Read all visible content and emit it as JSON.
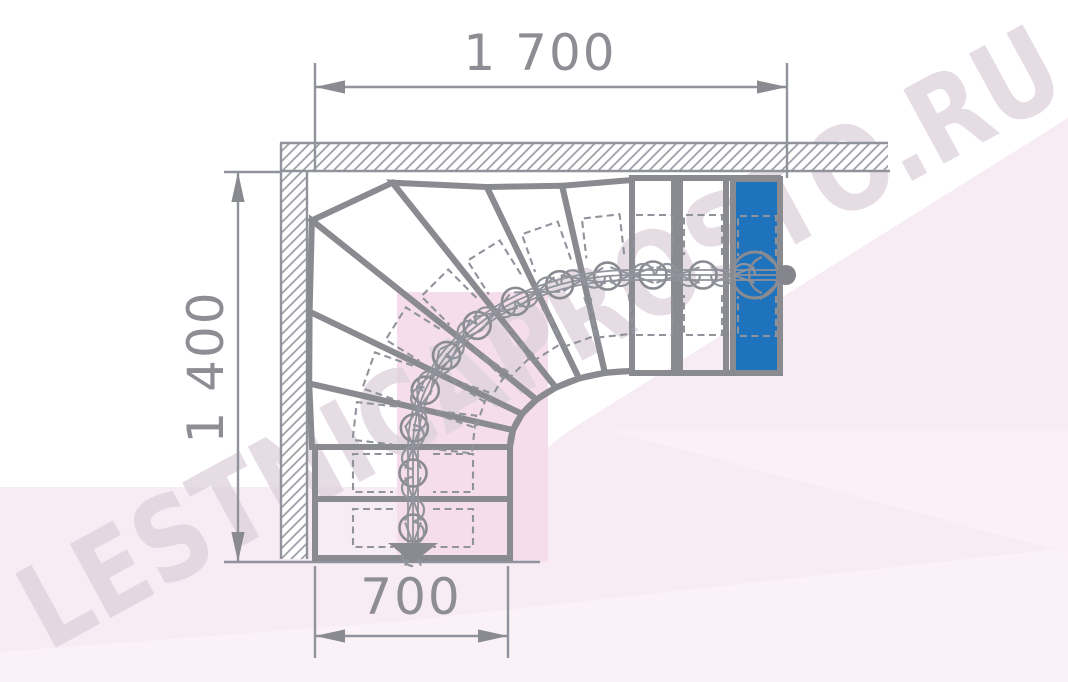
{
  "watermark": {
    "text": "LESTNICAPROSTO.RU"
  },
  "dimensions": {
    "top": "1 700",
    "left": "1 400",
    "bottom": "700"
  },
  "plan": {
    "straight_bottom_treads": 2,
    "winder_treads": 7,
    "right_treads": 3,
    "turn_angle_deg": 90,
    "highlighted_tread": "top-right landing tread (blue)"
  },
  "colors": {
    "line": "#8a8a91",
    "thin_line": "#90939b",
    "hatch": "#9a9aa3",
    "dim_text": "#8d8d93",
    "highlight_blue": "#1f72bc",
    "dot": "#85858d",
    "bg_pink": "#f8ecf4",
    "bg_pink_rect": "#f5ddeb",
    "bg_pink_light": "#fbf2f8",
    "white": "#ffffff"
  }
}
